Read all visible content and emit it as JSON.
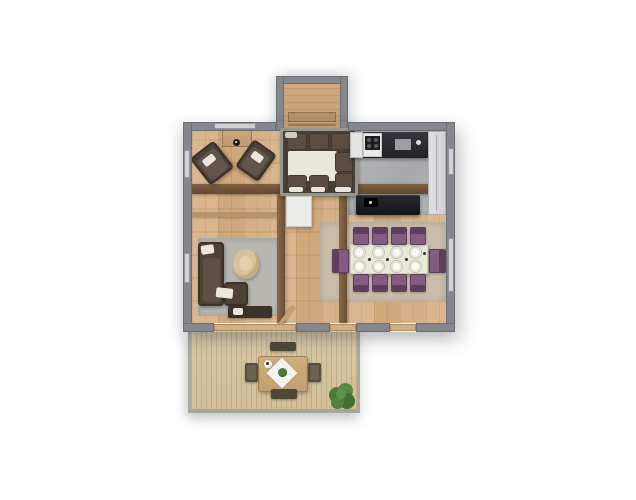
{
  "scene": {
    "type": "3d-floorplan-top-down-rendering",
    "background_color": "#ffffff",
    "visible_text": "none"
  },
  "palette": {
    "wall_gray": "#84878d",
    "window_gray": "#ced2d5",
    "interior_wood": "#d4ad82",
    "deck_wood": "#d9c8a5",
    "kitchen_floor_gray": "#adb0b2",
    "counter_dark": "#26282c",
    "island_black": "#17181b",
    "cabinet_white": "#d9dadb",
    "beam_brown": "#6e5138",
    "sofa_brown": "#4e4238",
    "dining_chair_purple": "#845c82",
    "dining_table_cream": "#ebe8da",
    "rug_living_gray": "#b9b7b1",
    "rug_dining_beige": "#cabdaa",
    "plant_green": "#4e7c3c"
  },
  "rooms": {
    "entry_porch": {
      "position": "top-center",
      "floor": "wood planks",
      "features": [
        "bench"
      ]
    },
    "lounge_nook": {
      "position": "top-center-inside",
      "sofa_cushions": 8,
      "center_surface": "cream"
    },
    "sitting_area": {
      "position": "top-left",
      "armchairs": 2,
      "console_table": 1
    },
    "kitchen": {
      "position": "top-right",
      "floor": "gray concrete",
      "counter_appliances": [
        "fridge",
        "cooktop",
        "sink"
      ],
      "island": 1,
      "tall_cabinet": 1
    },
    "living_room": {
      "position": "left",
      "sofa": "L-shaped brown",
      "swivel_chair": 1,
      "rug": "gray",
      "media_bench": 1
    },
    "dining_room": {
      "position": "right",
      "table": 1,
      "plates_on_table": 8,
      "side_chairs": 8,
      "end_armchairs": 2,
      "rug": "beige"
    },
    "deck": {
      "position": "bottom",
      "table": 1,
      "chairs": 2,
      "benches": 2,
      "potted_plant": 1,
      "tablecloth": "white diamond with plant centerpiece"
    }
  },
  "structure": {
    "horizontal_beams": 2,
    "vertical_posts": 2,
    "door_openings_to_deck": 3,
    "windows": 5
  }
}
